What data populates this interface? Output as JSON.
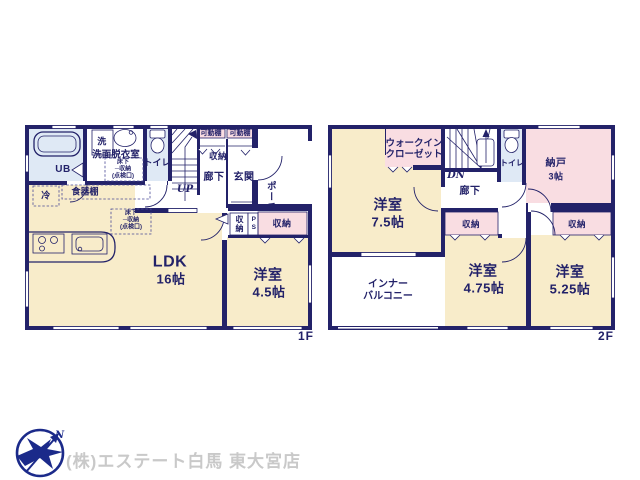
{
  "floor1": {
    "label": "1F",
    "rooms": {
      "ub": "UB",
      "laundry": "洗",
      "washroom": "洗面脱衣室",
      "toilet": "トイレ",
      "hallway": "廊下",
      "entrance": "玄関",
      "porch": "ポーチ",
      "ldk_name": "LDK",
      "ldk_size": "16帖",
      "bedroom_name": "洋室",
      "bedroom_size": "4.5帖"
    },
    "storage": {
      "shelf_left": "可動棚",
      "shelf_right": "可動棚",
      "hall_closet": "収納",
      "closet_side": "収納",
      "pipe_space": "PS",
      "closet_main": "収納",
      "underfloor_washroom": "床下\n─収納\n(点検口)",
      "underfloor_kitchen": "床下\n─収納\n(点検口)",
      "fridge": "冷",
      "cupboard": "食器棚"
    },
    "stairs": "UP"
  },
  "floor2": {
    "label": "2F",
    "rooms": {
      "room_main_name": "洋室",
      "room_main_size": "7.5帖",
      "room_mid_name": "洋室",
      "room_mid_size": "4.75帖",
      "room_right_name": "洋室",
      "room_right_size": "5.25帖",
      "storeroom_name": "納戸",
      "storeroom_size": "3帖",
      "toilet": "トイレ",
      "hallway": "廊下",
      "balcony": "インナー\nバルコニー",
      "wic": "ウォークイン\nクローゼット"
    },
    "storage": {
      "closet_mid": "収納",
      "closet_right": "収納"
    },
    "stairs": "DN"
  },
  "footer": {
    "company": "(株)エステート白馬 東大宮店",
    "compass_north": "N"
  },
  "colors": {
    "wall": "#232269",
    "room_cream": "#f8ecca",
    "closet_pink": "#f9dde2",
    "wet_blue": "#dfe9f5",
    "text_navy": "#232269",
    "company_gray": "#c9c9c9",
    "logo_blue": "#1b2a8a"
  }
}
